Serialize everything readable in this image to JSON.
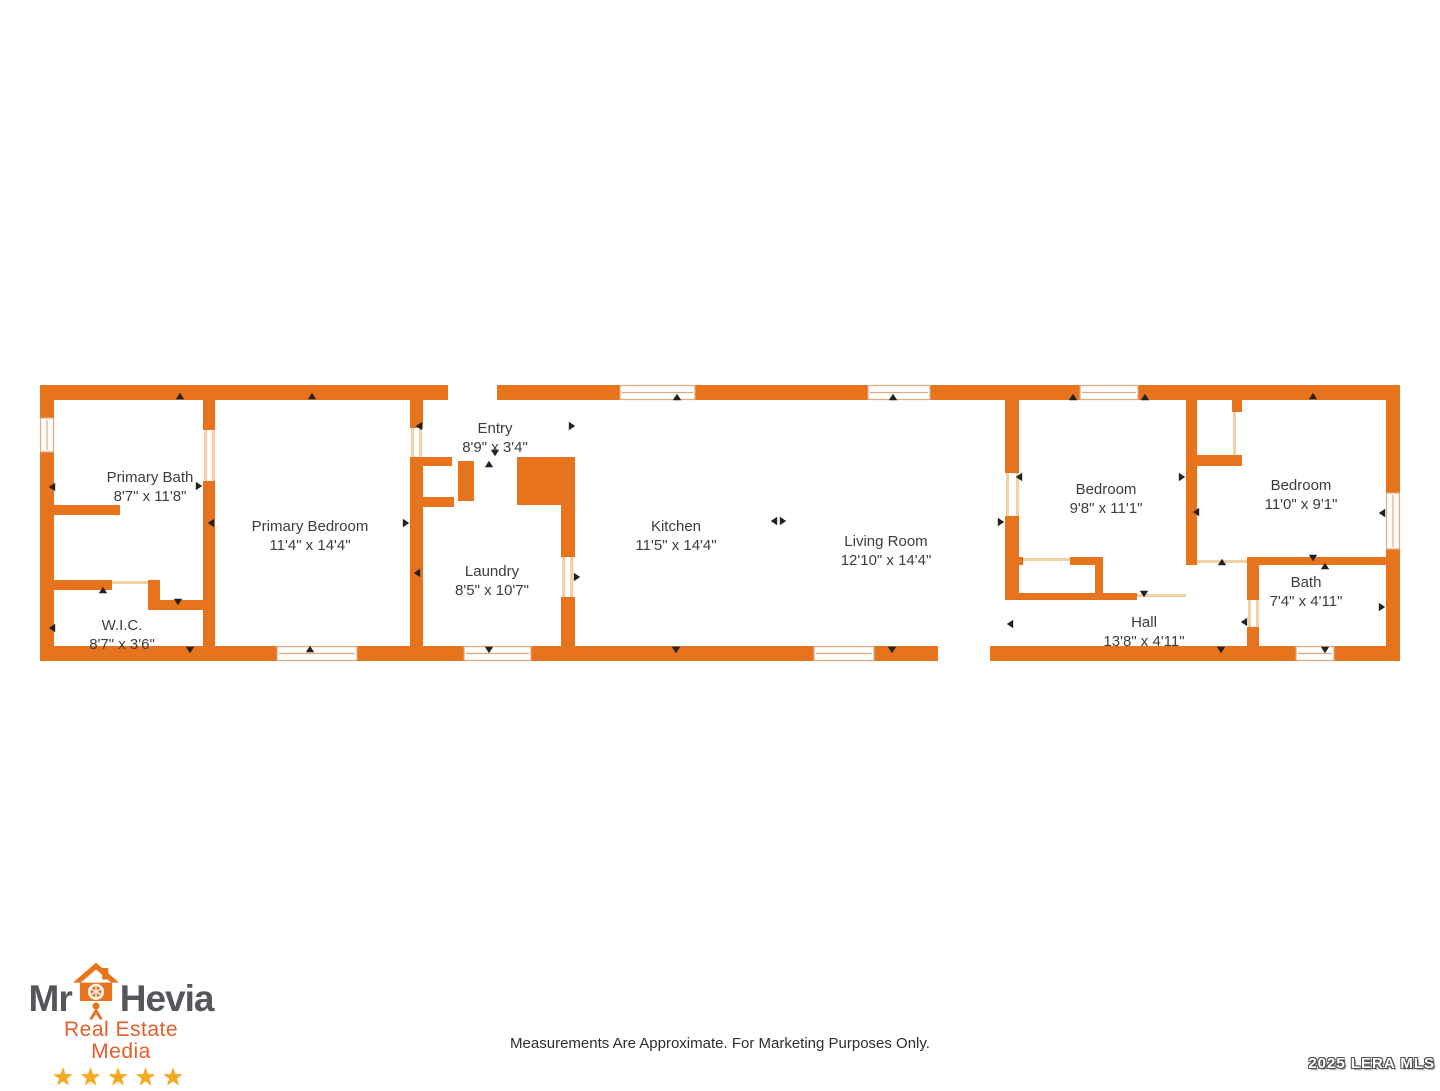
{
  "page": {
    "disclaimer": "Measurements Are Approximate. For Marketing Purposes Only.",
    "watermark": "2025 LERA MLS",
    "background": "#ffffff"
  },
  "logo": {
    "name_prefix": "Mr",
    "name_suffix": "Hevia",
    "tagline": "Real Estate Media",
    "stars": "★★★★★",
    "icon": "house-camera-person-icon",
    "colors": {
      "gray": "#55565B",
      "orange": "#E8731D",
      "tagline": "#E85C28",
      "star": "#F5A91F"
    }
  },
  "floorplan": {
    "colors": {
      "wall": "#E8731D",
      "window_frame": "#E3A87C",
      "opening_line": "#F2CFA5",
      "label": "#3D3D3D",
      "arrow": "#222222"
    },
    "rooms": [
      {
        "name": "Primary Bath",
        "dims": "8'7\" x 11'8\"",
        "x": 150,
        "y": 468
      },
      {
        "name": "W.I.C.",
        "dims": "8'7\" x 3'6\"",
        "x": 122,
        "y": 616
      },
      {
        "name": "Primary Bedroom",
        "dims": "11'4\" x 14'4\"",
        "x": 310,
        "y": 517
      },
      {
        "name": "Entry",
        "dims": "8'9\" x 3'4\"",
        "x": 495,
        "y": 419
      },
      {
        "name": "Laundry",
        "dims": "8'5\" x 10'7\"",
        "x": 492,
        "y": 562
      },
      {
        "name": "Kitchen",
        "dims": "11'5\" x 14'4\"",
        "x": 676,
        "y": 517
      },
      {
        "name": "Living Room",
        "dims": "12'10\" x 14'4\"",
        "x": 886,
        "y": 532
      },
      {
        "name": "Bedroom",
        "dims": "9'8\" x 11'1\"",
        "x": 1106,
        "y": 480
      },
      {
        "name": "Bedroom",
        "dims": "11'0\" x 9'1\"",
        "x": 1301,
        "y": 476
      },
      {
        "name": "Bath",
        "dims": "7'4\" x 4'11\"",
        "x": 1306,
        "y": 573
      },
      {
        "name": "Hall",
        "dims": "13'8\" x 4'11\"",
        "x": 1144,
        "y": 613
      }
    ]
  }
}
